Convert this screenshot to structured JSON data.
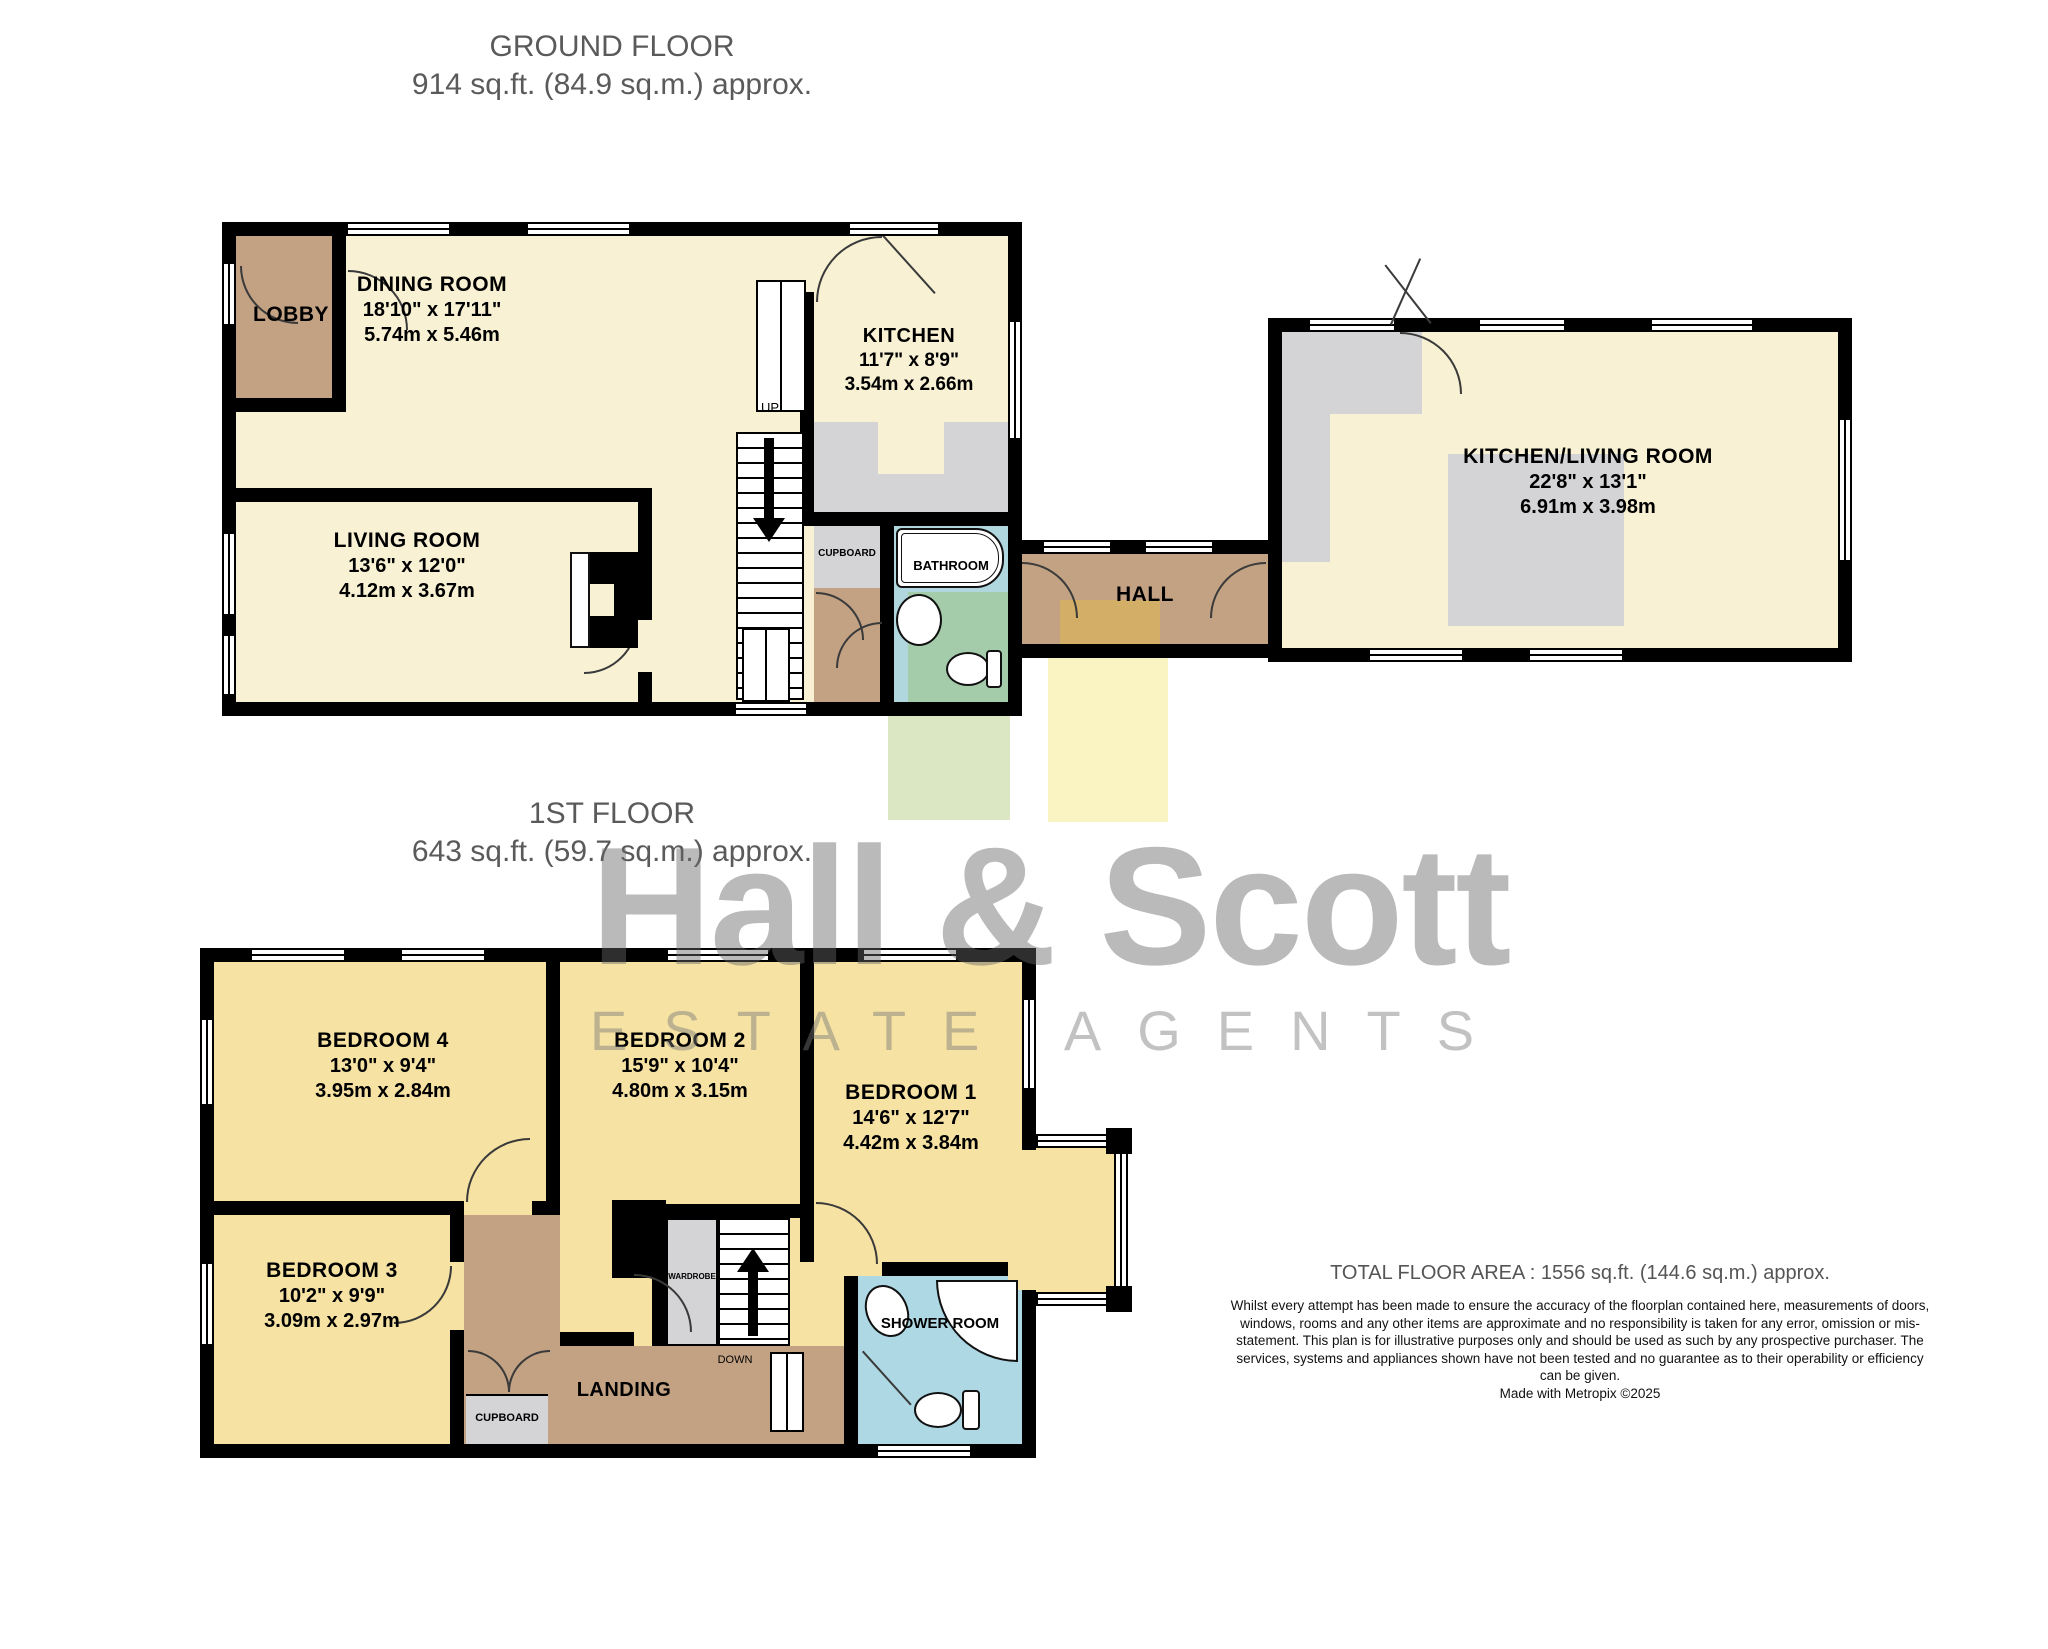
{
  "colors": {
    "wall": "#000000",
    "room_cream": "#f8f1d4",
    "bedroom_yellow": "#f6e2a3",
    "hall_brown": "#c3a284",
    "mat_ochre": "#d2ae66",
    "cupboard_gray": "#d4d4d6",
    "bathroom_blue": "#b0d6de",
    "bathroom_green": "#a4cbaa",
    "shower_blue": "#aed8e4",
    "patch_green": "#dbe6c2",
    "patch_yellow": "#faf3c2",
    "title_gray": "#5a5a5a"
  },
  "ground_floor": {
    "title": "GROUND FLOOR",
    "subtitle": "914 sq.ft. (84.9 sq.m.) approx.",
    "rooms": {
      "lobby": {
        "name": "LOBBY"
      },
      "dining": {
        "name": "DINING ROOM",
        "imperial": "18'10\"  x 17'11\"",
        "metric": "5.74m  x 5.46m"
      },
      "kitchen": {
        "name": "KITCHEN",
        "imperial": "11'7\"  x 8'9\"",
        "metric": "3.54m  x 2.66m"
      },
      "living": {
        "name": "LIVING ROOM",
        "imperial": "13'6\"  x 12'0\"",
        "metric": "4.12m  x 3.67m"
      },
      "cupboard": {
        "name": "CUPBOARD"
      },
      "bathroom": {
        "name": "BATHROOM"
      },
      "hall": {
        "name": "HALL"
      },
      "kitchen_living": {
        "name": "KITCHEN/LIVING ROOM",
        "imperial": "22'8\"  x 13'1\"",
        "metric": "6.91m  x 3.98m"
      },
      "up": "UP"
    }
  },
  "first_floor": {
    "title": "1ST FLOOR",
    "subtitle": "643 sq.ft. (59.7 sq.m.) approx.",
    "rooms": {
      "bedroom4": {
        "name": "BEDROOM 4",
        "imperial": "13'0\"  x 9'4\"",
        "metric": "3.95m  x 2.84m"
      },
      "bedroom2": {
        "name": "BEDROOM 2",
        "imperial": "15'9\"  x 10'4\"",
        "metric": "4.80m  x 3.15m"
      },
      "bedroom1": {
        "name": "BEDROOM 1",
        "imperial": "14'6\"  x 12'7\"",
        "metric": "4.42m  x 3.84m"
      },
      "bedroom3": {
        "name": "BEDROOM 3",
        "imperial": "10'2\"  x 9'9\"",
        "metric": "3.09m  x 2.97m"
      },
      "cupboard": {
        "name": "CUPBOARD"
      },
      "landing": {
        "name": "LANDING"
      },
      "wardrobe": {
        "name": "WARDROBE"
      },
      "shower": {
        "name": "SHOWER ROOM"
      },
      "down": "DOWN"
    }
  },
  "watermark": {
    "line1": "Hall & Scott",
    "line2": "ESTATE AGENTS"
  },
  "footer": {
    "total": "TOTAL FLOOR AREA : 1556 sq.ft. (144.6 sq.m.) approx.",
    "disclaimer": "Whilst every attempt has been made to ensure the accuracy of the floorplan contained here, measurements of doors, windows, rooms and any other items are approximate and no responsibility is taken for any error, omission or mis-statement. This plan is for illustrative purposes only and should be used as such by any prospective purchaser. The services, systems and appliances shown have not been tested and no guarantee as to their operability or efficiency can be given.",
    "credit": "Made with Metropix ©2025"
  }
}
